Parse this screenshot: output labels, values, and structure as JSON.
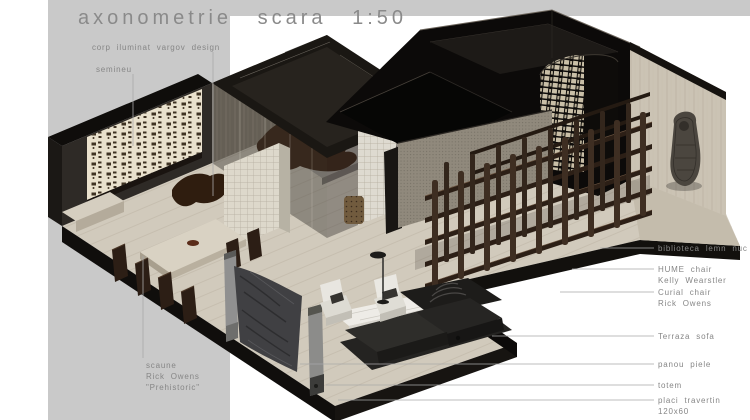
{
  "title": "axonometrie scara 1:50",
  "annotations": {
    "left": [
      {
        "id": "corp-iluminat",
        "text": "corp iluminat vargov design"
      },
      {
        "id": "semineu",
        "text": "semineu"
      },
      {
        "id": "scaune",
        "lines": [
          "scaune",
          "Rick Owens",
          "\"Prehistoric\""
        ]
      }
    ],
    "right": [
      {
        "id": "biblioteca",
        "lines": [
          "biblioteca lemn nuc"
        ]
      },
      {
        "id": "hume-chair",
        "lines": [
          "HUME chair",
          "Kelly Wearstler"
        ]
      },
      {
        "id": "curial-chair",
        "lines": [
          "Curial chair",
          "Rick Owens"
        ]
      },
      {
        "id": "terraza-sofa",
        "lines": [
          "Terraza sofa"
        ]
      },
      {
        "id": "panou-piele",
        "lines": [
          "panou piele"
        ]
      },
      {
        "id": "totem",
        "lines": [
          "totem"
        ]
      },
      {
        "id": "placi-travertin",
        "lines": [
          "placi travertin",
          "120x60"
        ]
      }
    ]
  },
  "colors": {
    "canvas_white": "#ffffff",
    "paper_gray": "#c9c9c9",
    "backdrop_white": "#ffffff",
    "floor_travertine": "#d1cabc",
    "dark_wall": "#16130f",
    "walnut_wood": "#3a2b1f",
    "cream_panel": "#e9e1cd",
    "travertine_wall": "#cbc3b4",
    "annotation_gray": "#868686"
  }
}
